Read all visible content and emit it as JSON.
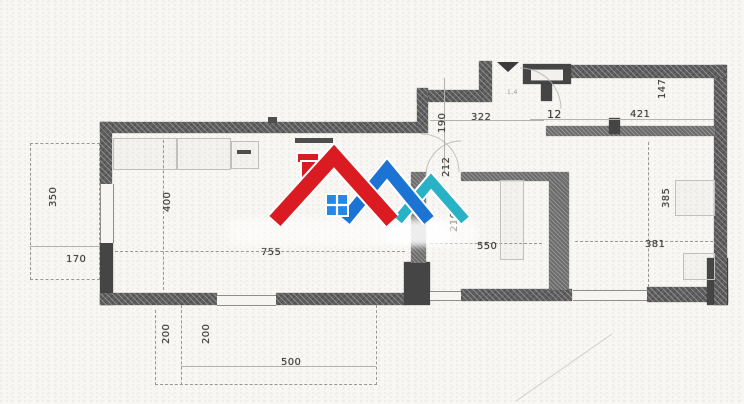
{
  "document": {
    "kind": "scanned apartment floor plan",
    "paper_color": "#f8f7f3"
  },
  "logo": {
    "description": "real-estate watermark: three overlapping roofs with chimney and window",
    "colors": {
      "red": "#da1b22",
      "blue": "#1b74d4",
      "teal": "#29b2c6",
      "window": "#2488e8",
      "outline": "#ffffff"
    }
  },
  "plan": {
    "wall_color": "#5e5e5e",
    "pier_color": "#454545",
    "dimension_labels": [
      {
        "text": "322",
        "cx": 471,
        "cy": 112,
        "rot": false
      },
      {
        "text": "190",
        "cx": 437,
        "cy": 133,
        "rot": true
      },
      {
        "text": "12",
        "cx": 547,
        "cy": 108,
        "rot": false,
        "fs": 11
      },
      {
        "text": "421",
        "cx": 630,
        "cy": 109,
        "rot": false
      },
      {
        "text": "147",
        "cx": 657,
        "cy": 99,
        "rot": true
      },
      {
        "text": "212",
        "cx": 441,
        "cy": 177,
        "rot": true
      },
      {
        "text": "216",
        "cx": 449,
        "cy": 232,
        "rot": true
      },
      {
        "text": "755",
        "cx": 261,
        "cy": 247,
        "rot": false
      },
      {
        "text": "400",
        "cx": 162,
        "cy": 212,
        "rot": true
      },
      {
        "text": "350",
        "cx": 48,
        "cy": 207,
        "rot": true
      },
      {
        "text": "170",
        "cx": 66,
        "cy": 254,
        "rot": false
      },
      {
        "text": "200",
        "cx": 161,
        "cy": 344,
        "rot": true
      },
      {
        "text": "200",
        "cx": 201,
        "cy": 344,
        "rot": true
      },
      {
        "text": "500",
        "cx": 281,
        "cy": 357,
        "rot": false
      },
      {
        "text": "550",
        "cx": 477,
        "cy": 241,
        "rot": false
      },
      {
        "text": "385",
        "cx": 661,
        "cy": 208,
        "rot": true
      },
      {
        "text": "381",
        "cx": 645,
        "cy": 239,
        "rot": false
      },
      {
        "text": "1,4",
        "cx": 507,
        "cy": 89,
        "rot": false,
        "fs": 6,
        "faint": true
      }
    ],
    "walls": [
      [
        100,
        122,
        317,
        11,
        "h"
      ],
      [
        100,
        122,
        12,
        62,
        "h"
      ],
      [
        100,
        243,
        13,
        62,
        "s"
      ],
      [
        100,
        293,
        117,
        12,
        "h"
      ],
      [
        276,
        293,
        131,
        12,
        "h"
      ],
      [
        404,
        262,
        26,
        43,
        "s"
      ],
      [
        461,
        289,
        111,
        12,
        "h"
      ],
      [
        647,
        287,
        81,
        15,
        "h"
      ],
      [
        707,
        258,
        21,
        47,
        "s"
      ],
      [
        714,
        65,
        13,
        240,
        "h"
      ],
      [
        569,
        65,
        157,
        13,
        "h"
      ],
      [
        523,
        64,
        48,
        20,
        "s"
      ],
      [
        541,
        84,
        11,
        17,
        "s"
      ],
      [
        479,
        61,
        13,
        41,
        "h"
      ],
      [
        417,
        90,
        64,
        12,
        "h"
      ],
      [
        417,
        88,
        11,
        45,
        "h"
      ],
      [
        546,
        126,
        169,
        10,
        "i"
      ],
      [
        609,
        118,
        11,
        16,
        "s"
      ],
      [
        411,
        172,
        15,
        91,
        "i"
      ],
      [
        461,
        172,
        95,
        9,
        "i"
      ],
      [
        549,
        172,
        20,
        118,
        "i"
      ]
    ],
    "shaft_box": [
      531,
      69,
      32,
      10
    ],
    "windows": [
      [
        100,
        184,
        12,
        59,
        "v"
      ],
      [
        217,
        295,
        59,
        9,
        "h"
      ],
      [
        430,
        291,
        31,
        8,
        "h"
      ],
      [
        573,
        290,
        74,
        9,
        "h"
      ]
    ],
    "dashed_lines": [
      [
        30,
        143,
        70,
        1
      ],
      [
        30,
        143,
        1,
        137
      ],
      [
        99,
        143,
        1,
        137
      ],
      [
        30,
        279,
        70,
        1
      ],
      [
        155,
        310,
        1,
        75
      ],
      [
        181,
        305,
        1,
        80
      ],
      [
        155,
        384,
        222,
        1
      ],
      [
        376,
        305,
        1,
        80
      ],
      [
        115,
        251,
        290,
        1
      ],
      [
        163,
        140,
        1,
        150
      ],
      [
        430,
        243,
        112,
        1
      ],
      [
        648,
        142,
        1,
        145
      ],
      [
        575,
        241,
        138,
        1
      ]
    ],
    "thin_lines": [
      [
        430,
        120,
        114,
        1
      ],
      [
        444,
        78,
        1,
        94
      ],
      [
        30,
        246,
        70,
        1
      ],
      [
        181,
        366,
        195,
        1
      ],
      [
        530,
        119,
        184,
        1
      ]
    ],
    "fixtures": [
      [
        113,
        138,
        62,
        30
      ],
      [
        177,
        138,
        52,
        30
      ],
      [
        231,
        141,
        26,
        26
      ],
      [
        500,
        180,
        22,
        78
      ],
      [
        675,
        180,
        38,
        34
      ],
      [
        683,
        253,
        30,
        25
      ]
    ],
    "dark_bars": [
      [
        295,
        138,
        38,
        5
      ],
      [
        268,
        117,
        9,
        6
      ],
      [
        237,
        150,
        14,
        4
      ]
    ]
  }
}
